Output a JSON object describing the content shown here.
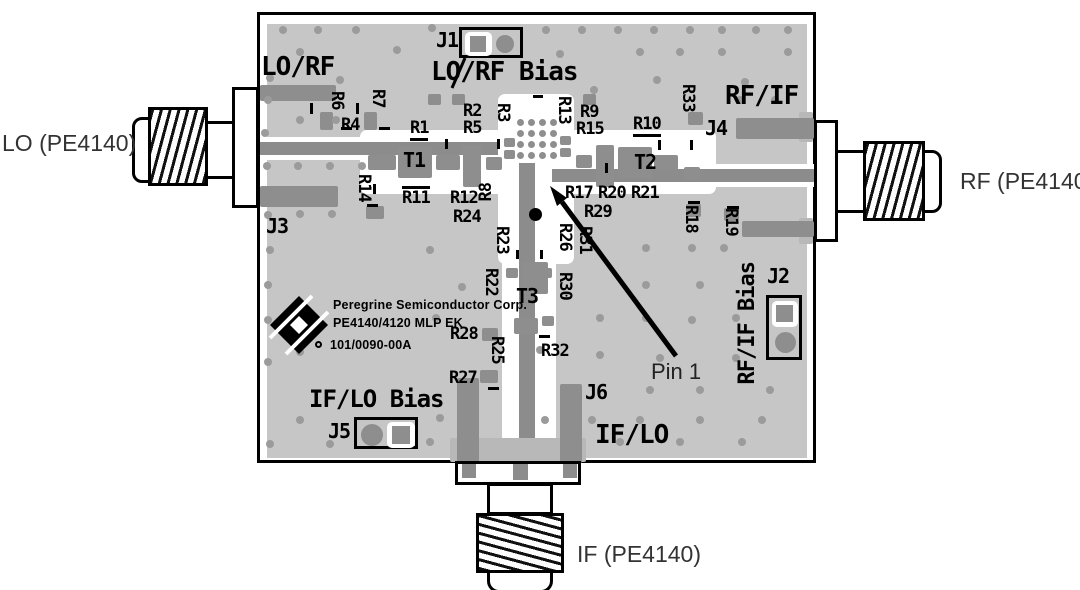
{
  "external": {
    "lo": "LO (PE4140)",
    "rf": "RF (PE4140)",
    "if": "IF (PE4140)"
  },
  "annotation": {
    "pin1": "Pin 1"
  },
  "silkscreen": {
    "lo_rf": "LO/RF",
    "lo_rf_bias": "LO/RF Bias",
    "rf_if": "RF/IF",
    "rf_if_bias": "RF/IF Bias",
    "if_lo_bias": "IF/LO Bias",
    "if_lo": "IF/LO"
  },
  "logo": {
    "company": "Peregrine Semiconductor Corp.",
    "product": "PE4140/4120 MLP EK",
    "part_number": "101/0090-00A"
  },
  "colors": {
    "board": "#c6c6c6",
    "pad": "#8e8e8e",
    "via": "#9b9b9b",
    "silkscreen": "#000000"
  },
  "refdes": [
    {
      "label": "R6",
      "x": 328,
      "y": 91,
      "d": "v"
    },
    {
      "label": "R7",
      "x": 369,
      "y": 89,
      "d": "v"
    },
    {
      "label": "R4",
      "x": 341,
      "y": 117,
      "d": "h"
    },
    {
      "label": "R1",
      "x": 410,
      "y": 120,
      "d": "h",
      "ul": true
    },
    {
      "label": "R2",
      "x": 463,
      "y": 103,
      "d": "h"
    },
    {
      "label": "R5",
      "x": 463,
      "y": 120,
      "d": "h"
    },
    {
      "label": "R3",
      "x": 494,
      "y": 103,
      "d": "v"
    },
    {
      "label": "R13",
      "x": 555,
      "y": 96,
      "d": "v"
    },
    {
      "label": "R9",
      "x": 580,
      "y": 104,
      "d": "h"
    },
    {
      "label": "R15",
      "x": 576,
      "y": 121,
      "d": "h"
    },
    {
      "label": "R10",
      "x": 633,
      "y": 116,
      "d": "h",
      "ul": true
    },
    {
      "label": "R33",
      "x": 679,
      "y": 84,
      "d": "v"
    },
    {
      "label": "T1",
      "x": 403,
      "y": 150,
      "d": "h",
      "s": "tl"
    },
    {
      "label": "T2",
      "x": 634,
      "y": 152,
      "d": "h",
      "s": "tl"
    },
    {
      "label": "R14",
      "x": 355,
      "y": 174,
      "d": "v"
    },
    {
      "label": "R11",
      "x": 402,
      "y": 186,
      "d": "h",
      "ol": true
    },
    {
      "label": "R12",
      "x": 450,
      "y": 190,
      "d": "h"
    },
    {
      "label": "R8",
      "x": 478,
      "y": 183,
      "d": "u"
    },
    {
      "label": "R24",
      "x": 453,
      "y": 209,
      "d": "h"
    },
    {
      "label": "R23",
      "x": 493,
      "y": 226,
      "d": "v"
    },
    {
      "label": "R17",
      "x": 565,
      "y": 185,
      "d": "h"
    },
    {
      "label": "R20",
      "x": 598,
      "y": 185,
      "d": "h"
    },
    {
      "label": "R21",
      "x": 631,
      "y": 185,
      "d": "h"
    },
    {
      "label": "R29",
      "x": 584,
      "y": 204,
      "d": "h"
    },
    {
      "label": "R26",
      "x": 556,
      "y": 223,
      "d": "v"
    },
    {
      "label": "R31",
      "x": 576,
      "y": 226,
      "d": "v"
    },
    {
      "label": "R18",
      "x": 682,
      "y": 205,
      "d": "v"
    },
    {
      "label": "R19",
      "x": 722,
      "y": 208,
      "d": "v"
    },
    {
      "label": "R22",
      "x": 482,
      "y": 268,
      "d": "v"
    },
    {
      "label": "T3",
      "x": 516,
      "y": 286,
      "d": "h",
      "s": "tl"
    },
    {
      "label": "R30",
      "x": 556,
      "y": 272,
      "d": "v"
    },
    {
      "label": "R28",
      "x": 450,
      "y": 326,
      "d": "h"
    },
    {
      "label": "R25",
      "x": 488,
      "y": 336,
      "d": "v"
    },
    {
      "label": "R32",
      "x": 541,
      "y": 343,
      "d": "h"
    },
    {
      "label": "R27",
      "x": 449,
      "y": 370,
      "d": "h"
    },
    {
      "label": "J1",
      "x": 436,
      "y": 30,
      "d": "h",
      "s": "jl"
    },
    {
      "label": "J2",
      "x": 767,
      "y": 266,
      "d": "h",
      "s": "jl"
    },
    {
      "label": "J3",
      "x": 266,
      "y": 216,
      "d": "h",
      "s": "jl"
    },
    {
      "label": "J4",
      "x": 705,
      "y": 118,
      "d": "h",
      "s": "jl"
    },
    {
      "label": "J5",
      "x": 328,
      "y": 421,
      "d": "h",
      "s": "jl"
    },
    {
      "label": "J6",
      "x": 585,
      "y": 382,
      "d": "h",
      "s": "jl"
    }
  ]
}
